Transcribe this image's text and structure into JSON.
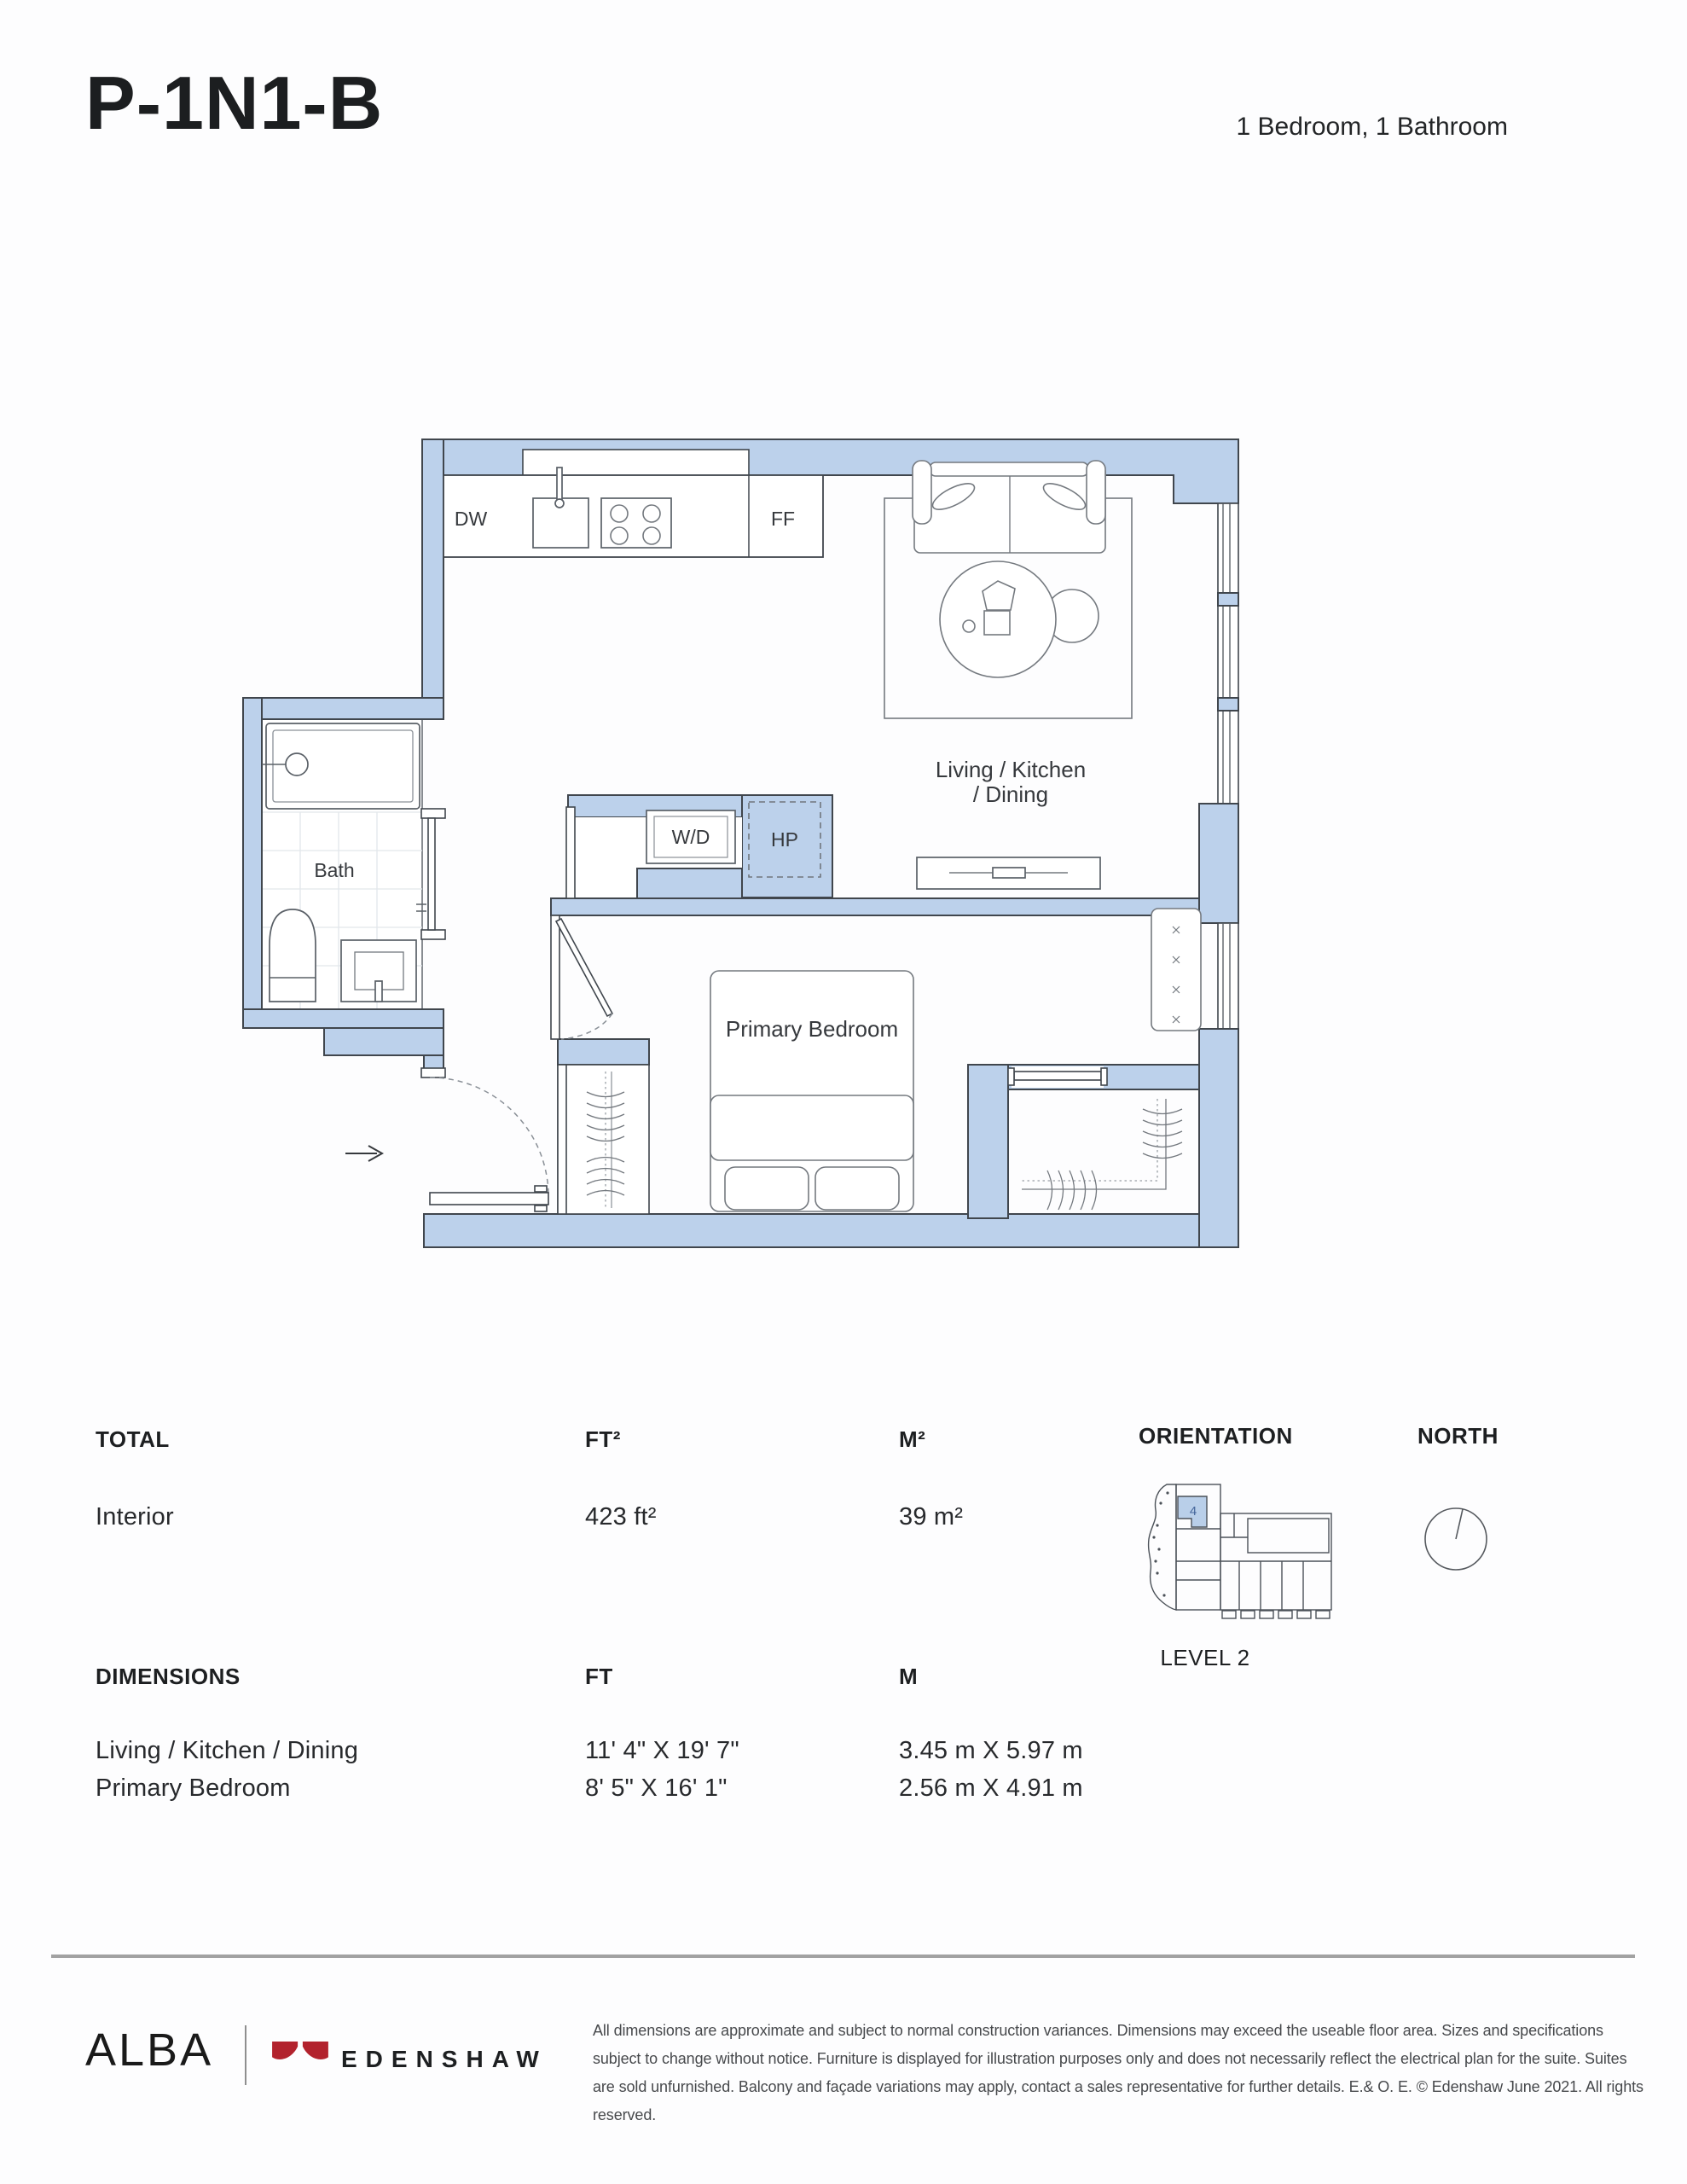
{
  "header": {
    "plan_code": "P-1N1-B",
    "unit_type": "1 Bedroom, 1 Bathroom"
  },
  "floorplan": {
    "labels": {
      "dw": "DW",
      "ff": "FF",
      "wd": "W/D",
      "hp": "HP",
      "bath": "Bath",
      "living1": "Living / Kitchen",
      "living2": "/ Dining",
      "bedroom": "Primary Bedroom"
    }
  },
  "total_table": {
    "header": {
      "label": "TOTAL",
      "ft": "FT²",
      "m": "M²"
    },
    "rows": [
      {
        "label": "Interior",
        "ft": "423 ft²",
        "m": "39 m²"
      }
    ]
  },
  "dimensions_table": {
    "header": {
      "label": "DIMENSIONS",
      "ft": "FT",
      "m": "M"
    },
    "rows": [
      {
        "label": "Living / Kitchen / Dining",
        "ft": "11' 4\" X 19' 7\"",
        "m": "3.45 m X 5.97 m"
      },
      {
        "label": "Primary Bedroom",
        "ft": "8' 5\" X 16' 1\"",
        "m": "2.56 m X 4.91 m"
      }
    ]
  },
  "orientation": {
    "title": "ORIENTATION",
    "north_label": "NORTH",
    "level_label": "LEVEL 2",
    "unit_number": "4"
  },
  "footer": {
    "brand": "ALBA",
    "developer": "EDENSHAW",
    "disclaimer": "All dimensions are approximate and subject to normal construction variances. Dimensions may exceed the useable floor area. Sizes and specifications subject to change without notice. Furniture is displayed for illustration purposes only and does not necessarily reflect the electrical plan for the suite. Suites are sold unfurnished. Balcony and façade variations may apply, contact a sales representative for further details. E.& O. E. © Edenshaw June 2021. All rights reserved."
  },
  "colors": {
    "wall_fill": "#bcd1eb",
    "wall_stroke": "#40464d",
    "accent_red": "#b2222d",
    "highlight_unit": "#b9cfe9"
  }
}
